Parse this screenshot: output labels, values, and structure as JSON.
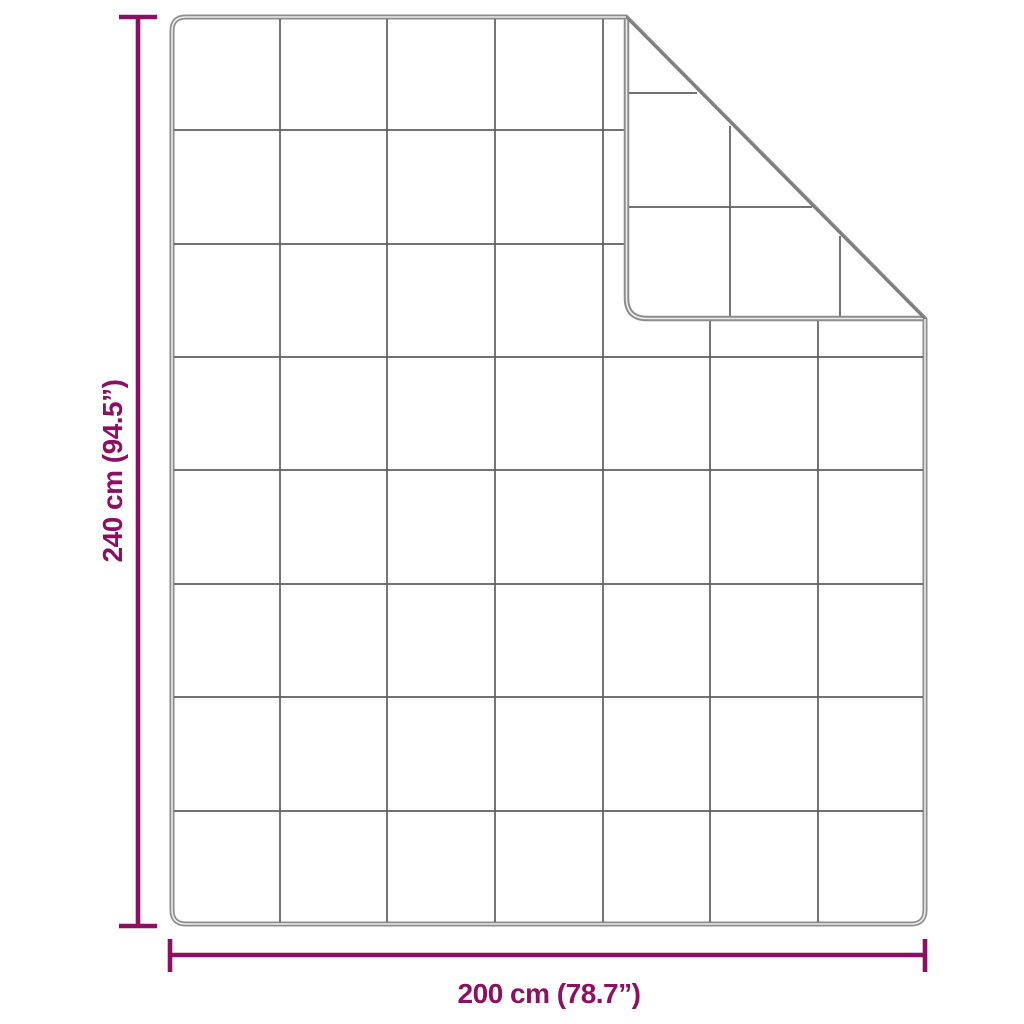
{
  "diagram": {
    "type": "blanket-dimension-diagram",
    "dimensions": {
      "height": {
        "label": "240 cm (94.5”)"
      },
      "width": {
        "label": "200 cm (78.7”)"
      }
    },
    "blanket": {
      "rows": 8,
      "columns": 7,
      "folded_corner": "top-right",
      "grid_segments_main": [
        [
          280,
          19,
          280,
          922
        ],
        [
          387,
          19,
          387,
          922
        ],
        [
          495,
          19,
          495,
          922
        ],
        [
          603,
          19,
          603,
          922
        ],
        [
          710,
          321,
          710,
          922
        ],
        [
          818,
          321,
          818,
          922
        ],
        [
          174,
          130,
          624,
          130
        ],
        [
          174,
          244,
          624,
          244
        ],
        [
          174,
          357,
          923,
          357
        ],
        [
          174,
          470,
          923,
          470
        ],
        [
          174,
          584,
          923,
          584
        ],
        [
          174,
          697,
          923,
          697
        ],
        [
          174,
          811,
          923,
          811
        ]
      ],
      "grid_segments_flap": [
        [
          627,
          93,
          697,
          93
        ],
        [
          627,
          207,
          812,
          207
        ],
        [
          730,
          126,
          730,
          317
        ],
        [
          840,
          236,
          840,
          317
        ]
      ]
    },
    "colors": {
      "dimension": "#8c0f63",
      "outline": "#8c8c8c",
      "outline_core": "#ececec",
      "grid_line": "#5e5e5e",
      "fold_line": "#7d7d7d",
      "background": "#ffffff"
    }
  }
}
